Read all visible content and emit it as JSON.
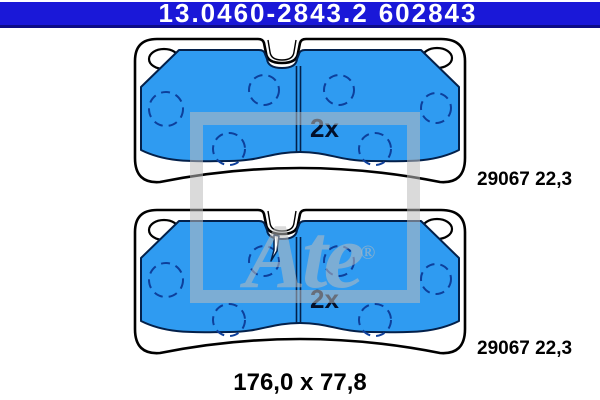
{
  "header": {
    "part_number": "13.0460-2843.2",
    "reference_number": "602843"
  },
  "drawing": {
    "top_pad": {
      "quantity": "2x",
      "reference": "29067 22,3"
    },
    "bottom_pad": {
      "quantity": "2x",
      "reference": "29067 22,3"
    },
    "dimensions": "176,0 x 77,8"
  },
  "watermark": {
    "logo_text": "Ate",
    "registered_mark": "®"
  },
  "colors": {
    "header_bg": "#1a18d8",
    "header_border": "#0d0c86",
    "header_text": "#ffffff",
    "pad_blue": "#2f9bf1",
    "outline_navy": "#03204a",
    "dash_blue": "#0d3f9b",
    "qty_color": "#02102a",
    "label_color": "#000000",
    "wm": "rgba(187,187,187,0.55)"
  }
}
